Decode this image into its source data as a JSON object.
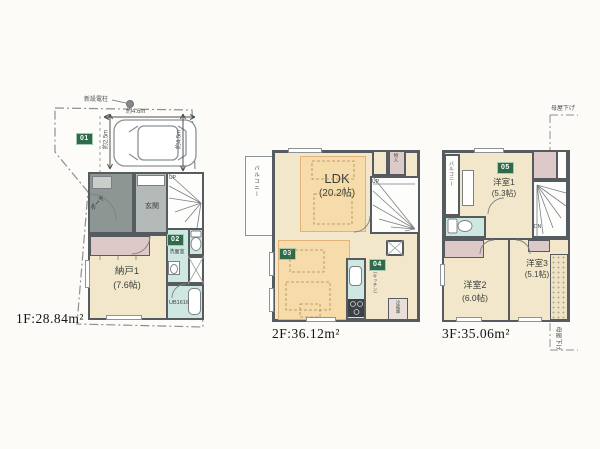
{
  "colors": {
    "badge_green": "#2e6b4a",
    "wall_gray": "#565b60",
    "tatami_cream": "#f3e7cb",
    "wet_area_teal": "#cfe7e1",
    "closet_pink": "#ddcac8",
    "furniture_orange": "#f6dcab"
  },
  "f1": {
    "area": "1F:28.84m²",
    "badge_parking": "01",
    "badge_sanitary": "02",
    "pole_label": "新設電柱",
    "dim_width": "約4.6m",
    "dim_depth": "約2.5m",
    "dim_side": "約4.5m",
    "porch": "ポーチ",
    "genkan": "玄関",
    "up": "UP",
    "washroom": "洗面室",
    "bath": "UB1616",
    "storage_name": "納戸1",
    "storage_size": "(7.6帖)"
  },
  "f2": {
    "area": "2F:36.12m²",
    "balcony": "バルコニー",
    "ldk_name": "LDK",
    "ldk_size": "(20.2帖)",
    "badge_living": "03",
    "badge_kitchen": "04",
    "closet": "物入",
    "kitchen_note": "(キッチン)",
    "fridge": "冷蔵庫",
    "up": "UP"
  },
  "f3": {
    "area": "3F:35.06m²",
    "balcony": "バルコニー",
    "badge_room1": "05",
    "room1_name": "洋室1",
    "room1_size": "(5.3帖)",
    "room2_name": "洋室2",
    "room2_size": "(6.0帖)",
    "room3_name": "洋室3",
    "room3_size": "(5.1帖)",
    "dn": "DN",
    "roof_note_top": "母屋下げ",
    "roof_note_bottom": "母屋下げ"
  }
}
